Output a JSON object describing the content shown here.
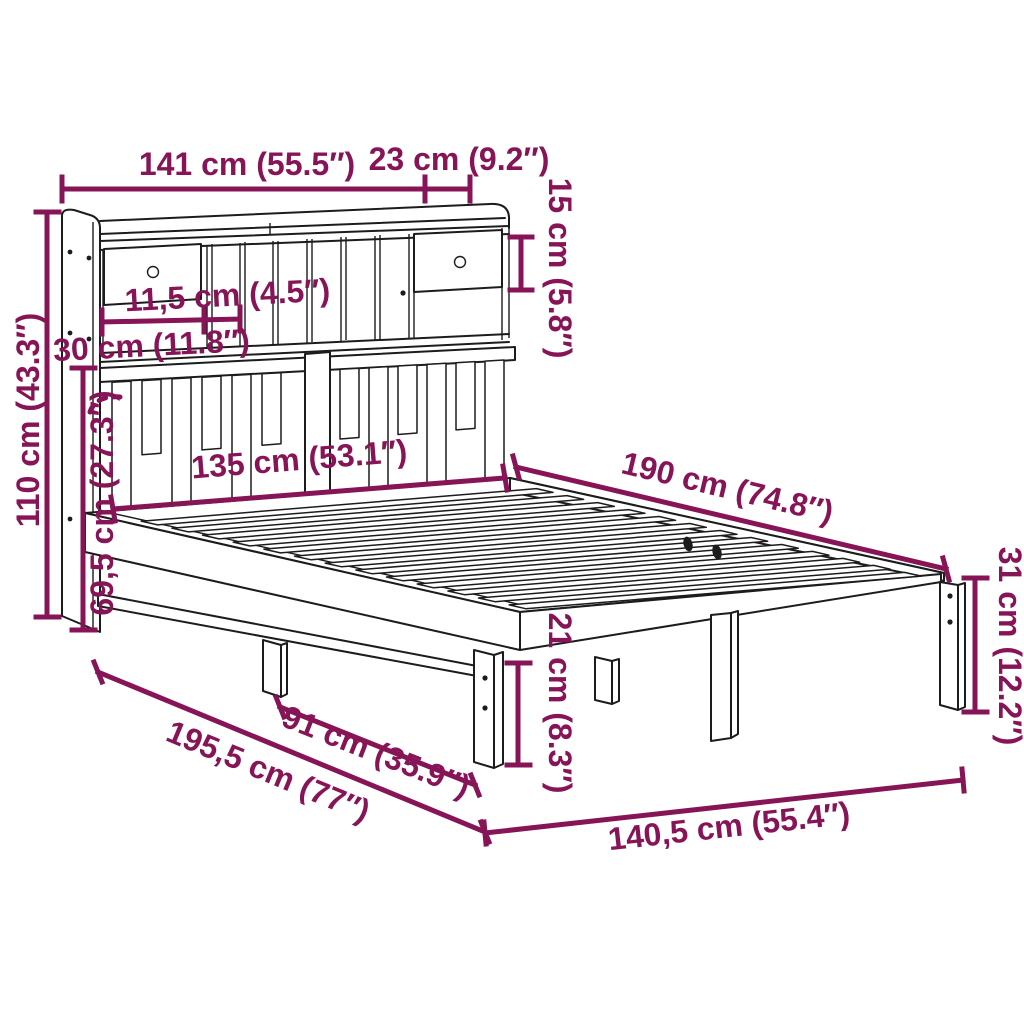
{
  "diagram": {
    "type": "product-dimension-diagram",
    "subject": "bed frame with bookcase headboard",
    "colors": {
      "dimension_annotations": "#861457",
      "outline": "#1c1c1c",
      "background": "#ffffff"
    },
    "dimensions": [
      {
        "name": "headboard-total-width",
        "label": "141 cm (55.5″)"
      },
      {
        "name": "shelf-depth",
        "label": "23 cm (9.2″)"
      },
      {
        "name": "shelf-opening-height",
        "label": "15 cm (5.8″)"
      },
      {
        "name": "slot-width",
        "label": "11,5 cm (4.5″)"
      },
      {
        "name": "compartment-width",
        "label": "30 cm (11.8″)"
      },
      {
        "name": "headboard-height",
        "label": "110 cm (43.3″)"
      },
      {
        "name": "headboard-lower-height",
        "label": "69,5 cm (27.3″)"
      },
      {
        "name": "inner-width",
        "label": "135 cm (53.1″)"
      },
      {
        "name": "bed-length",
        "label": "190 cm (74.8″)"
      },
      {
        "name": "corner-leg-height",
        "label": "31 cm (12.2″)"
      },
      {
        "name": "under-bed-clearance",
        "label": "21 cm (8.3″)"
      },
      {
        "name": "leg-spacing",
        "label": "91 cm (35.9″)"
      },
      {
        "name": "total-length",
        "label": "195,5 cm (77″)"
      },
      {
        "name": "frame-width",
        "label": "140,5 cm (55.4″)"
      }
    ]
  }
}
